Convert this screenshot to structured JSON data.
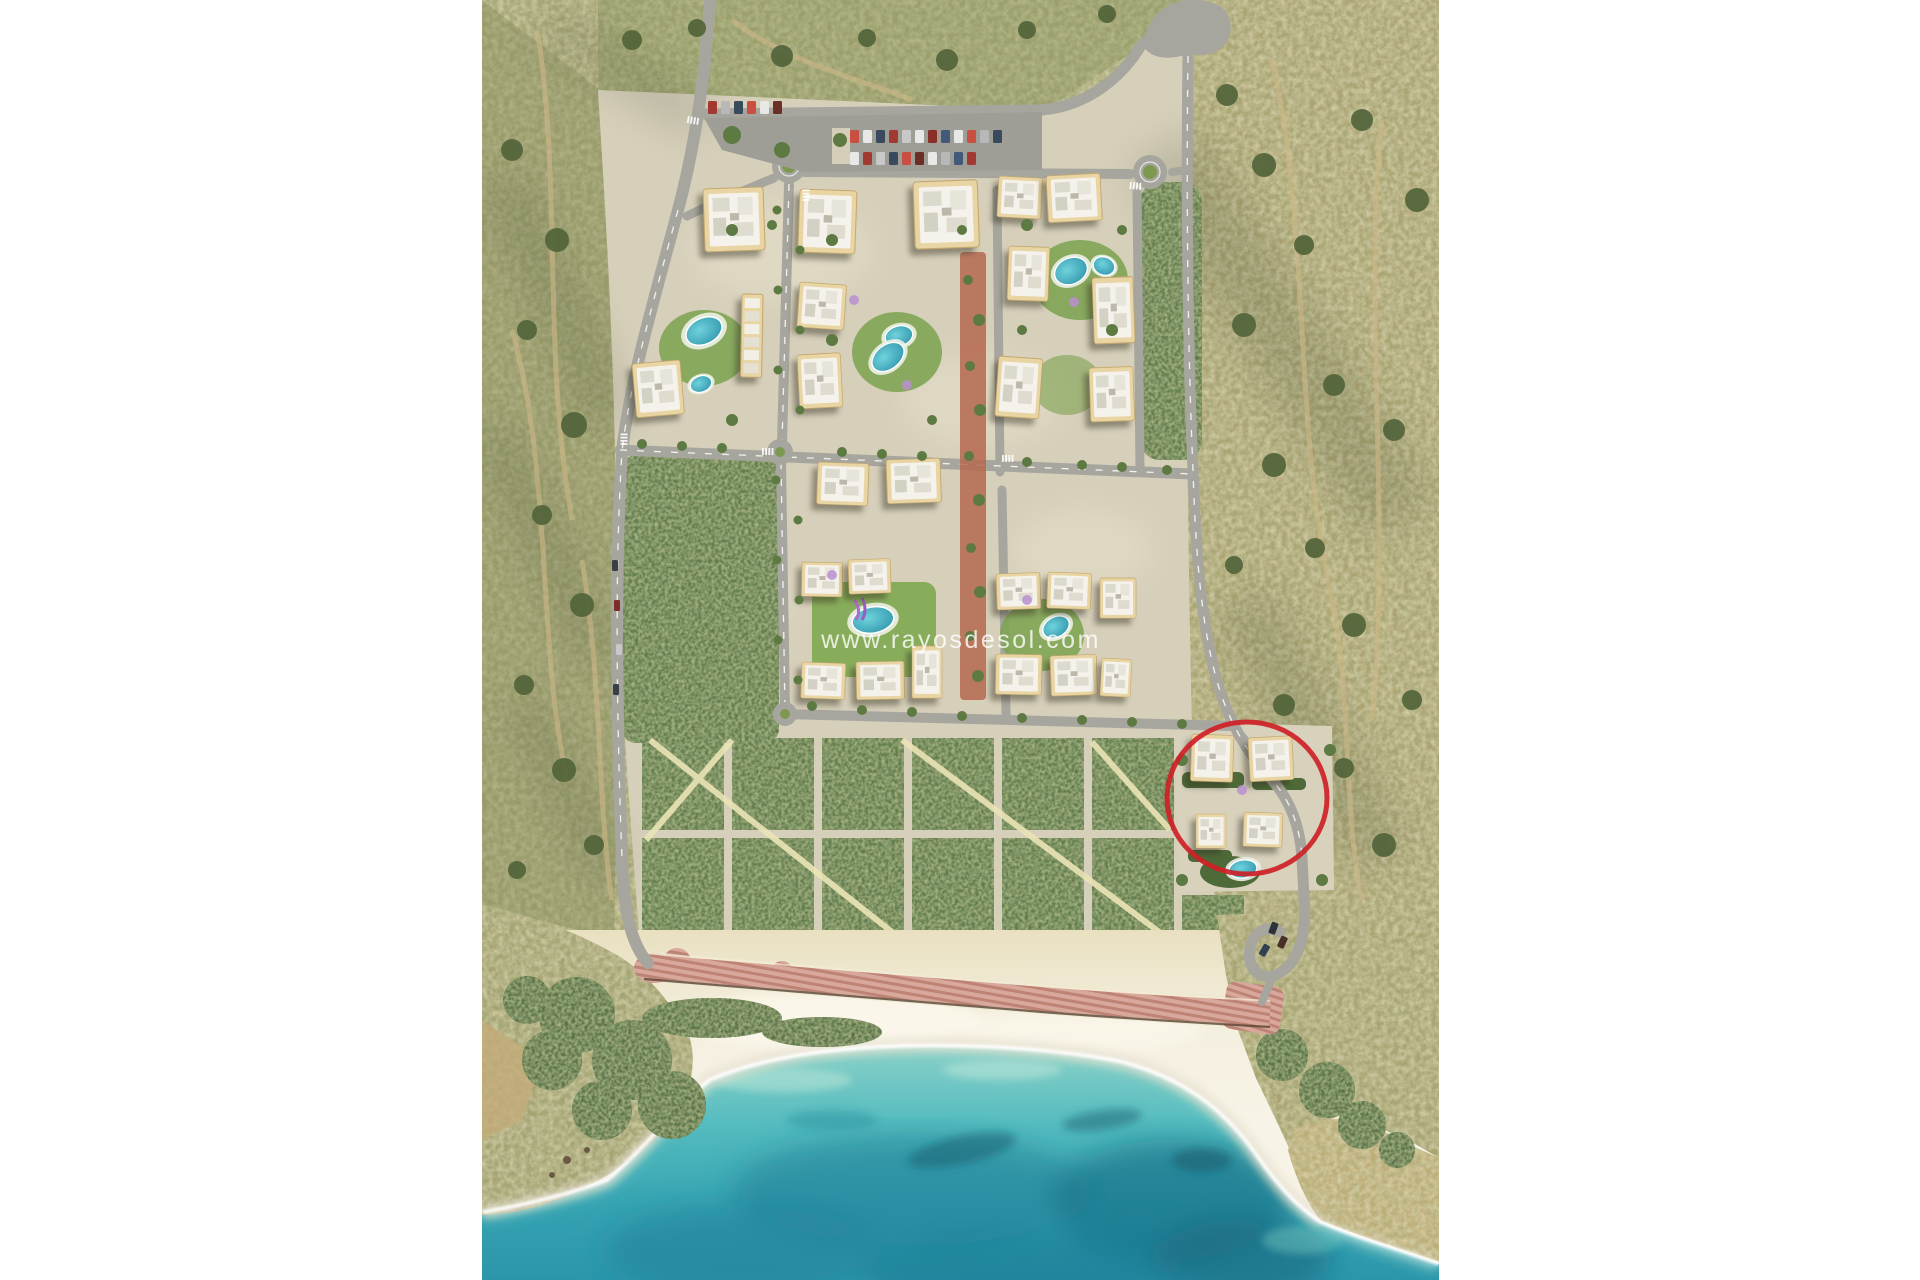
{
  "page": {
    "background_color": "#ffffff"
  },
  "photo": {
    "kind": "aerial render of coastal residential masterplan",
    "subject": "apartment blocks with pools, parking lot, orchard park grid, pink beach promenade, white sand bay and turquoise sea surrounded by scrubland hills",
    "watermark": {
      "text": "www.rayosdesol.com",
      "color": "#ffffff"
    },
    "annotation": {
      "shape": "circle",
      "purpose": "highlights small building cluster with pool near the beach",
      "color": "#ce2127"
    },
    "palette": {
      "scrubland": "#a9a374",
      "parcel_ground": "#d6cfba",
      "roads": "#a7a69e",
      "buildings": "#e9d5a4",
      "rooftops": "#f4f2ea",
      "vegetation": "#5a7340",
      "lawn": "#80a454",
      "pool_water": "#3aa9bd",
      "promenade": "#d8a49a",
      "sand": "#f4efdf",
      "sea_shallow": "#8ed2c9",
      "sea_deep": "#2b96aa",
      "highlight_red": "#ce2127"
    }
  }
}
